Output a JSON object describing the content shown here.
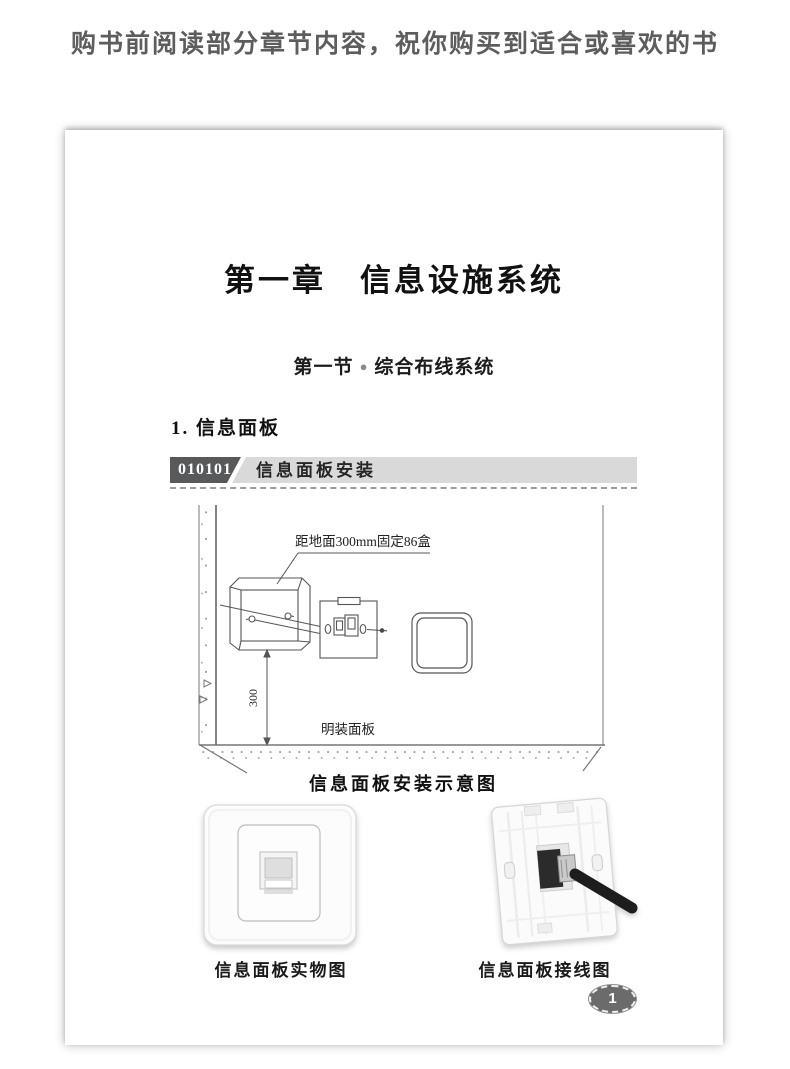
{
  "banner": {
    "text": "购书前阅读部分章节内容，祝你购买到适合或喜欢的书"
  },
  "page": {
    "chapter_title": "第一章　信息设施系统",
    "section": {
      "prefix": "第一节",
      "bullet": "●",
      "title": "综合布线系统"
    },
    "heading": "1. 信息面板",
    "topic_bar": {
      "code": "010101",
      "label": "信息面板安装"
    },
    "diagram": {
      "callout": "距地面300mm固定86盒",
      "dimension": "300",
      "floor_label": "明装面板",
      "caption": "信息面板安装示意图"
    },
    "photos": [
      {
        "caption": "信息面板实物图"
      },
      {
        "caption": "信息面板接线图"
      }
    ],
    "page_number": "1"
  },
  "colors": {
    "banner_text": "#5d5d5d",
    "topic_code_bg": "#58595b",
    "topic_bar_bg": "#d9d9d9",
    "page_number_bg": "#6b6b6b",
    "diagram_line": "#555555"
  }
}
